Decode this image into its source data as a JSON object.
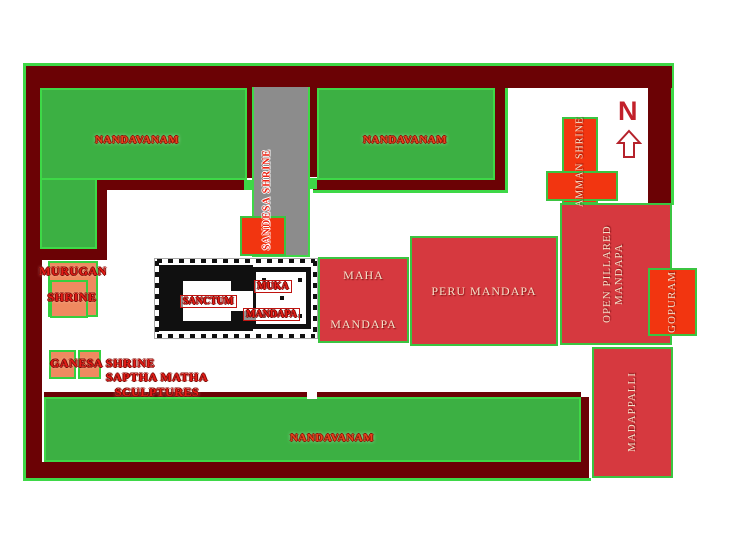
{
  "map": {
    "compass": {
      "label": "N"
    },
    "gardens": [
      {
        "id": "top-left",
        "label": "NANDAVANAM"
      },
      {
        "id": "top-right",
        "label": "NANDAVANAM"
      },
      {
        "id": "bottom",
        "label": "NANDAVANAM"
      }
    ],
    "shrines": {
      "sandesa": {
        "label": "SANDESA SHRINE"
      },
      "amman": {
        "label": "AMMAN SHRINE"
      },
      "murugan": {
        "line1": "MURUGAN",
        "line2": "SHRINE"
      },
      "ganesa": {
        "label": "GANESA SHRINE"
      },
      "saptha_matha": {
        "label": "SAPTHA MATHA SCULPTURES"
      }
    },
    "temple_plan": {
      "sanctum": {
        "label": "SANCTUM"
      },
      "muka_mandapa": {
        "line1": "MUKA",
        "line2": "MANDAPA"
      }
    },
    "mandapas": {
      "maha": {
        "line1": "MAHA",
        "line2": "MANDAPA"
      },
      "peru": {
        "label": "PERU MANDAPA"
      },
      "open_pillared": {
        "label": "OPEN PILLARED MANDAPA"
      }
    },
    "structures": {
      "gopuram": {
        "label": "GOPURAM"
      },
      "madappalli": {
        "label": "MADAPPALLI"
      }
    }
  },
  "colors": {
    "wall_maroon": "#6b0205",
    "garden_green": "#3cb043",
    "highlight_green": "#3ed847",
    "zone_red": "#d6393f",
    "shrine_orange": "#f23510",
    "shrine_salmon": "#ef8a60",
    "path_gray": "#8c8c8c",
    "label_red": "#e41c16",
    "zone_text_cream": "#f5dfc8",
    "compass_red": "#c2202a"
  }
}
